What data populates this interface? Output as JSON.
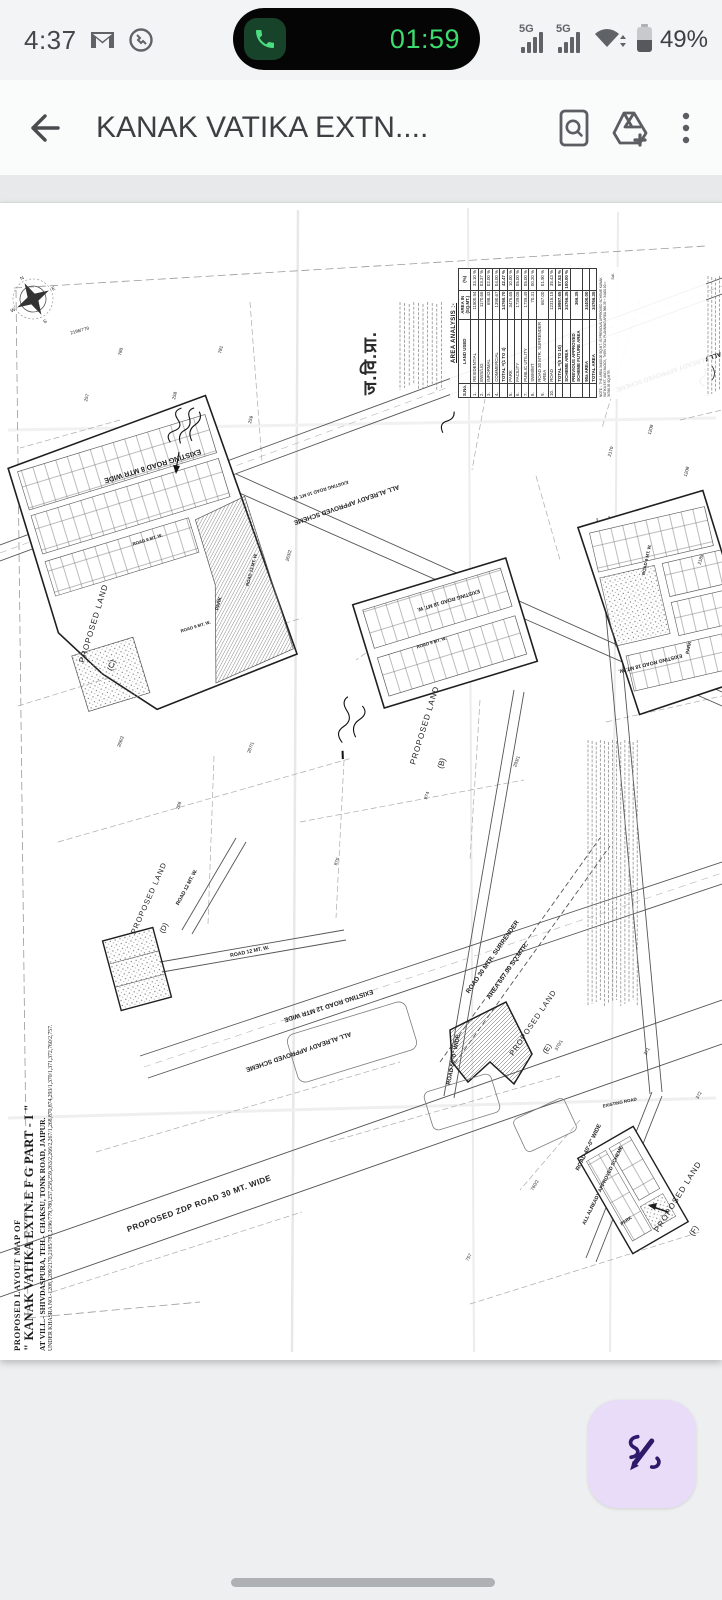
{
  "status_bar": {
    "time": "4:37",
    "icons": [
      "gmail-notification-icon",
      "phone-notification-icon"
    ],
    "call_timer": "01:59",
    "network_badge": "5G",
    "battery_percent": "49%",
    "call_pill_color": "#050505",
    "call_green": "#3ddc6e"
  },
  "app_bar": {
    "title": "KANAK VATIKA EXTN....",
    "icons": [
      "back-arrow-icon",
      "find-in-document-icon",
      "add-to-drive-icon",
      "more-options-icon"
    ]
  },
  "fab": {
    "icon": "scribble-pen-icon",
    "bg": "#e8dcf8",
    "ink": "#2d1a6b"
  },
  "document": {
    "stamp": "ज.वि.प्रा.",
    "compass": {
      "n": "N",
      "e": "E",
      "s": "S",
      "w": "W"
    },
    "title_block": {
      "l1": "PROPOSED LAYOUT MAP OF",
      "l2": "\" KANAK VATIKA EXTN.E F G PART - I \"",
      "l3": "AT VILL.-  SHIVDASPURA, TEH.- CHAKSU, TONK ROAD, JAIPUR.",
      "l4": "UNDER KHASRA NO.-1208,1209/2170,2185/781,2196/779,780,257,258,259,263/2,266/2,267/1,268,870,874,293/1,370/1,371,372,760/2,757."
    },
    "area_table": {
      "title": "AREA ANALYSIS :-",
      "headers": [
        "S.No.",
        "LAND USED",
        "AREA IN (SQ.MT.)",
        "(%)"
      ],
      "rows": [
        [
          "1.",
          "RESIDENTIAL",
          "11500.94",
          "33.10 %"
        ],
        [
          "2.",
          "EWS/LIG",
          "1170.66",
          "03.37 %"
        ],
        [
          "3.",
          "INFORMAL",
          "698.43",
          "02.00 %"
        ],
        [
          "4.",
          "COMMERCIAL",
          "1390.67",
          "04.00 %"
        ],
        [
          "",
          "TOTAL =(1 TO 4)",
          "14760.70",
          "42.47 %"
        ],
        [
          "5.",
          "PARK",
          "3476.65",
          "10.00 %"
        ],
        [
          "6.",
          "FACILITY",
          "1739.05",
          "05.00 %"
        ],
        [
          "7.",
          "PUBLIC UTILITY",
          "1739.49",
          "05.00 %"
        ],
        [
          "8.",
          "SWM/MT",
          "70.31",
          "00.20 %"
        ],
        [
          "9.",
          "ROAD 30 MTR. SURRENDER AREA",
          "657.00",
          "01.90 %"
        ],
        [
          "10.",
          "ROAD",
          "12315.15",
          "35.43 %"
        ],
        [
          "",
          "TOTAL =(5 TO 10)",
          "19997.65",
          "57.53 %"
        ],
        [
          "",
          "SCHEME AREA",
          "34766.35",
          "100.00 %"
        ],
        [
          "",
          "PREVIOUS APPROVED SCHEME FUTURE AREA",
          "366.35",
          ""
        ],
        [
          "",
          "90a AREA",
          "34400.00",
          ""
        ],
        [
          "",
          "TOTAL AREA",
          "34766.35",
          ""
        ]
      ],
      "note": "NOTE :- THE AREA 34400.00 SQ.MT. IS PREVIOUS APPROVED SCHEME KANAK VATIKA EXT. AND BLOCK, THEN TOTAL PLANNING AREA 366.35 + 34400.00 = 34766.35 SQ.MTR.",
      "signature": "Sd/-"
    },
    "map_labels": [
      {
        "t": "EXISTING ROAD 8 MTR WIDE",
        "x": 152,
        "y": 464,
        "r": 163,
        "s": 7.2,
        "b": true
      },
      {
        "t": "EXISTING ROAD 10 MT. W.",
        "x": 320,
        "y": 489,
        "r": 163,
        "s": 4.6,
        "b": true
      },
      {
        "t": "ALL ALREADY APPROVED SCHEME",
        "x": 346,
        "y": 503,
        "r": 161,
        "s": 6.4,
        "b": true
      },
      {
        "t": "ALL ALREADY APPROVED SCHEME",
        "x": 668,
        "y": 370,
        "r": 161,
        "s": 6.4,
        "b": true
      },
      {
        "t": "EXISTING ROAD 18 MT. W.",
        "x": 448,
        "y": 599,
        "r": 163,
        "s": 5.2,
        "b": true
      },
      {
        "t": "EXISTING ROAD 18 MT. W.",
        "x": 650,
        "y": 662,
        "r": 166,
        "s": 5.2,
        "b": true
      },
      {
        "t": "ROAD 13 MT. W.",
        "x": 253,
        "y": 570,
        "r": -75,
        "s": 4.4,
        "b": true
      },
      {
        "t": "ROAD 9 MT. W.",
        "x": 148,
        "y": 541,
        "r": -17,
        "s": 4.4,
        "b": true
      },
      {
        "t": "ROAD 9 MT. W.",
        "x": 196,
        "y": 628,
        "r": -17,
        "s": 4.4,
        "b": true
      },
      {
        "t": "ROAD 9 MT. W.",
        "x": 432,
        "y": 644,
        "r": -17,
        "s": 4.4,
        "b": true
      },
      {
        "t": "ROAD 9 MT. W.",
        "x": 648,
        "y": 560,
        "r": -78,
        "s": 4.4,
        "b": true
      },
      {
        "t": "PARK",
        "x": 220,
        "y": 604,
        "r": -75,
        "s": 5,
        "b": true
      },
      {
        "t": "PARK",
        "x": 690,
        "y": 648,
        "r": -78,
        "s": 4.6,
        "b": true
      },
      {
        "t": "PARK",
        "x": 627,
        "y": 1222,
        "r": -35,
        "s": 4.6,
        "b": true
      },
      {
        "t": "PROPOSED LAND",
        "x": 96,
        "y": 624,
        "r": -73,
        "s": 8,
        "ls": 1
      },
      {
        "t": "(C)",
        "x": 114,
        "y": 666,
        "r": -73,
        "s": 8
      },
      {
        "t": "PROPOSED LAND",
        "x": 427,
        "y": 726,
        "r": -73,
        "s": 8,
        "ls": 1
      },
      {
        "t": "(B)",
        "x": 444,
        "y": 764,
        "r": -73,
        "s": 8
      },
      {
        "t": "PROPOSED LAND",
        "x": 151,
        "y": 899,
        "r": -66,
        "s": 7.5,
        "ls": 1
      },
      {
        "t": "(D)",
        "x": 166,
        "y": 929,
        "r": -66,
        "s": 7.5
      },
      {
        "t": "PROPOSED LAND",
        "x": 535,
        "y": 1024,
        "r": -56,
        "s": 7.5,
        "ls": 1
      },
      {
        "t": "(E)",
        "x": 549,
        "y": 1050,
        "r": -56,
        "s": 7.5
      },
      {
        "t": "PROPOSED LAND",
        "x": 680,
        "y": 1198,
        "r": -58,
        "s": 8,
        "ls": 1
      },
      {
        "t": "(F)",
        "x": 696,
        "y": 1232,
        "r": -58,
        "s": 8
      },
      {
        "t": "ROAD 30 MTR. SURRENDER",
        "x": 494,
        "y": 958,
        "r": -55,
        "s": 6.4,
        "b": true
      },
      {
        "t": "AREA 657.00 SQ.MTR.",
        "x": 509,
        "y": 972,
        "r": -55,
        "s": 6.4,
        "b": true
      },
      {
        "t": "ROAD 50'-0\" WIDE",
        "x": 455,
        "y": 1060,
        "r": -79,
        "s": 5.8,
        "b": true
      },
      {
        "t": "ROAD 40'-0\" WIDE",
        "x": 590,
        "y": 1148,
        "r": -64,
        "s": 5.8,
        "b": true
      },
      {
        "t": "ALL ALREADY APPROVED SCHEME",
        "x": 604,
        "y": 1186,
        "r": -64,
        "s": 5,
        "b": true
      },
      {
        "t": "PROPOSED ZDP ROAD 30 MT. WIDE",
        "x": 200,
        "y": 1206,
        "r": -20,
        "s": 8,
        "b": true,
        "ls": 0.5
      },
      {
        "t": "EXISTING ROAD 12 MTR WIDE",
        "x": 328,
        "y": 1004,
        "r": 162,
        "s": 6.4,
        "b": true
      },
      {
        "t": "ALL ALREADY APPROVED SCHEME",
        "x": 298,
        "y": 1050,
        "r": 161,
        "s": 6.4,
        "b": true
      },
      {
        "t": "ROAD 12 MT. W.",
        "x": 188,
        "y": 888,
        "r": -62,
        "s": 5.2,
        "b": true
      },
      {
        "t": "ROAD 12 MT. W.",
        "x": 250,
        "y": 953,
        "r": -12,
        "s": 5.2,
        "b": true
      },
      {
        "t": "EXISTING ROAD",
        "x": 620,
        "y": 1104,
        "r": -12,
        "s": 4.4,
        "b": true
      }
    ],
    "khasra_numbers": [
      {
        "t": "257",
        "x": 88,
        "y": 398,
        "r": -75
      },
      {
        "t": "258",
        "x": 176,
        "y": 396,
        "r": -75
      },
      {
        "t": "259",
        "x": 252,
        "y": 420,
        "r": -75
      },
      {
        "t": "780",
        "x": 122,
        "y": 352,
        "r": -75
      },
      {
        "t": "781",
        "x": 222,
        "y": 350,
        "r": -75
      },
      {
        "t": "263/2",
        "x": 290,
        "y": 556,
        "r": -75
      },
      {
        "t": "266/2",
        "x": 122,
        "y": 742,
        "r": -70
      },
      {
        "t": "267/1",
        "x": 252,
        "y": 748,
        "r": -70
      },
      {
        "t": "268",
        "x": 180,
        "y": 806,
        "r": -70
      },
      {
        "t": "870",
        "x": 338,
        "y": 862,
        "r": -70
      },
      {
        "t": "874",
        "x": 428,
        "y": 796,
        "r": -70
      },
      {
        "t": "293/1",
        "x": 518,
        "y": 762,
        "r": -70
      },
      {
        "t": "370/1",
        "x": 560,
        "y": 1046,
        "r": -60
      },
      {
        "t": "371",
        "x": 648,
        "y": 1052,
        "r": -60
      },
      {
        "t": "372",
        "x": 700,
        "y": 1096,
        "r": -60
      },
      {
        "t": "760/2",
        "x": 536,
        "y": 1186,
        "r": -60
      },
      {
        "t": "757",
        "x": 470,
        "y": 1258,
        "r": -60
      },
      {
        "t": "1208",
        "x": 688,
        "y": 472,
        "r": -75
      },
      {
        "t": "1209",
        "x": 652,
        "y": 430,
        "r": -75
      },
      {
        "t": "2170",
        "x": 612,
        "y": 452,
        "r": -75
      },
      {
        "t": "2185",
        "x": 702,
        "y": 560,
        "r": -75
      },
      {
        "t": "2196/779",
        "x": 80,
        "y": 332,
        "r": -15
      }
    ],
    "fineprint_blocks": [
      {
        "x": 588,
        "y1": 740,
        "y2": 1006,
        "count": 13,
        "step": 4.1
      },
      {
        "x": 708,
        "y1": 276,
        "y2": 396,
        "count": 4,
        "step": 3.8
      },
      {
        "x": 400,
        "y1": 302,
        "y2": 390,
        "count": 10,
        "step": 4.6
      }
    ]
  }
}
